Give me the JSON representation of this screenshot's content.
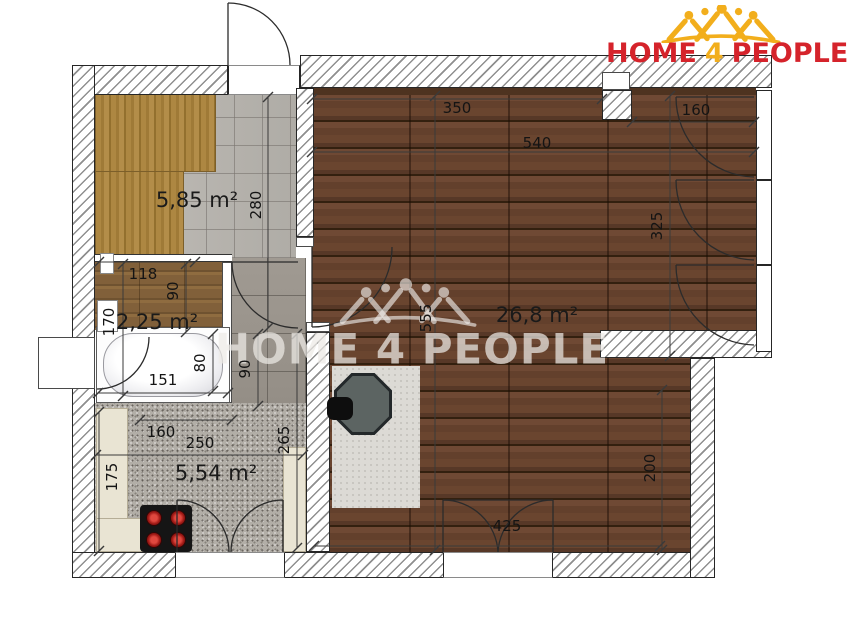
{
  "logo": {
    "home": "HOME",
    "four": "4",
    "people": "PEOPLE"
  },
  "watermark": {
    "text": "HOME 4 PEOPLE"
  },
  "rooms": {
    "hallway": {
      "area": "5,85 m²"
    },
    "bathroom": {
      "area": "2,25 m²"
    },
    "kitchen": {
      "area": "5,54 m²"
    },
    "living": {
      "area": "26,8 m²"
    }
  },
  "dimensions": {
    "top_350": "350",
    "top_540": "540",
    "tr_160": "160",
    "right_325": "325",
    "mid_555": "555",
    "lr_200": "200",
    "bottom_425": "425",
    "hall_280": "280",
    "bath_118": "118",
    "bath_90": "90",
    "bath_170": "170",
    "tub_151": "151",
    "tub_80": "80",
    "corr_90": "90",
    "corr_265": "265",
    "kit_160": "160",
    "kit_250": "250",
    "kit_175": "175"
  },
  "colors": {
    "brand_red": "#d5232b",
    "brand_gold": "#f2ae1c"
  }
}
